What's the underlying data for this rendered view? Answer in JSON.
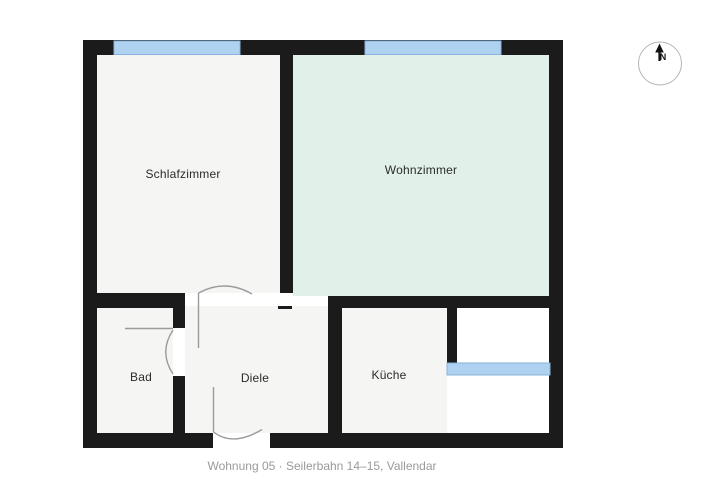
{
  "caption": "Wohnung 05 · Seilerbahn 14–15, Vallendar",
  "compass": {
    "north_label": "N"
  },
  "rooms": [
    {
      "id": "schlafzimmer",
      "label": "Schlafzimmer"
    },
    {
      "id": "wohnzimmer",
      "label": "Wohnzimmer"
    },
    {
      "id": "bad",
      "label": "Bad"
    },
    {
      "id": "diele",
      "label": "Diele"
    },
    {
      "id": "kueche",
      "label": "Küche"
    }
  ],
  "colors": {
    "wall": "#1b1b1b",
    "window_fill": "#aed2f0",
    "window_stroke": "#8ab2dc",
    "room_gray": "#f5f5f4",
    "room_mint": "#e1f0e9",
    "door_stroke": "#9b9b9b",
    "label": "#2b2b2b",
    "caption": "#9a9a9a",
    "compass_stroke": "#b5b5b5",
    "north": "#111111"
  }
}
